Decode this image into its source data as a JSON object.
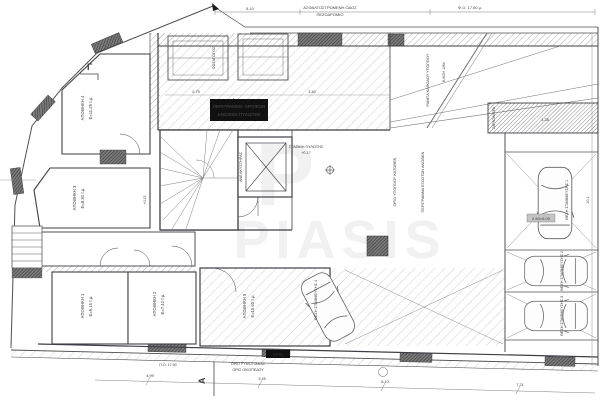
{
  "drawing": {
    "watermark": {
      "text": "PIASIS",
      "logo_letter": "Ρ"
    },
    "street": {
      "label1": "ΑΣΦΑΛΤΟΣΤΡΩΜΕΝΗ ΟΔΟΣ",
      "label2": "ΠΕΖΟΔΡΟΜΙΟ",
      "width_note": "Φ.Ο. 17.50 μ."
    },
    "boundary": {
      "line1": "ΟΡΙΟ ΡΥΜΟΤΟΜΙΑΣ",
      "line2": "ΟΡΙΟ ΟΙΚΟΠΕΔΟΥ",
      "box_label": "ΟΡΙΟ",
      "road_width": "Π.Ο. 17.50"
    },
    "outline_box": {
      "line1": "ΠΕΡΙΓΡΑΜΜΑ ΟΡΟΦΩΝ",
      "line2": "ΑΝΩΘΕΝ ΠΥΛΩΤΗΣ"
    },
    "markers": {
      "section_gamma": "Γ",
      "section_a": "Α"
    },
    "levels": {
      "pilotis_caption": "ΣΤΑΘΜΗ ΠΥΛΩΤΗΣ",
      "pilotis_value": "+0.17",
      "corridor_value": "+0.15"
    },
    "core": {
      "elevator": "ΑΝΕΛΚΥΣΤΗΡΑΣ",
      "skylight": "ΦΩΤΑΓΩΓΟΣ"
    },
    "rooms": {
      "a": {
        "name": "ΑΠΟΘΗΚΗ 4",
        "area": "Ε=11.25 τ.μ."
      },
      "b": {
        "name": "ΑΠΟΘΗΚΗ 3",
        "area": "Ε=8.30 τ.μ."
      },
      "c": {
        "name": "ΑΠΟΘΗΚΗ 1",
        "area": "Ε=9.15 τ.μ."
      },
      "d": {
        "name": "ΑΠΟΘΗΚΗ 2",
        "area": "Ε=7.42 τ.μ."
      },
      "g": {
        "name": "ΑΠΟΘΗΚΗ 5",
        "area": "Ε=15.60 τ.μ."
      }
    },
    "ramp": {
      "note1": "ΡΑΜΠΑ ΚΑΘΟΔΟΥ ΥΠΟΓΕΙΟΥ",
      "note2": "ΚΛΙΣΗ 18%",
      "planter": "ΖΑΡΝΤΙΝΙΕΡΑ"
    },
    "notes": {
      "n1": "ΟΡΙΟ ΥΠΟΓΕΙΟΥ ΚΑΤΩΘΕΝ",
      "n2": "ΠΕΡΙΓΡΑΜΜΑ ΕΞΩΣΤΩΝ ΑΝΩΘΕΝ"
    },
    "parking": {
      "s1": "ΘΕΣΗ ΣΤΑΘΜΕΥΣΗΣ 1",
      "s2": "ΘΕΣΗ ΣΤΑΘΜΕΥΣΗΣ 2",
      "s3": "ΘΕΣΗ ΣΤΑΘΜΕΥΣΗΣ 3",
      "s4": "ΘΕΣΗ ΣΤΑΘΜΕΥΣΗΣ 4",
      "badge": "2.50×5.00"
    },
    "dims": {
      "top1": "8.10",
      "in1": "2.75",
      "in2": "3.40",
      "right1": "10.1",
      "planter_len": "4.38",
      "b1": "4.99",
      "b2": "3.45",
      "b3": "6.10",
      "b4": "7.21"
    },
    "colors": {
      "line": "#474747",
      "hatch": "#9b9b9b",
      "wall_dark": "#6e6e6e",
      "watermark": "#dedede",
      "label_box": "#111111"
    }
  }
}
